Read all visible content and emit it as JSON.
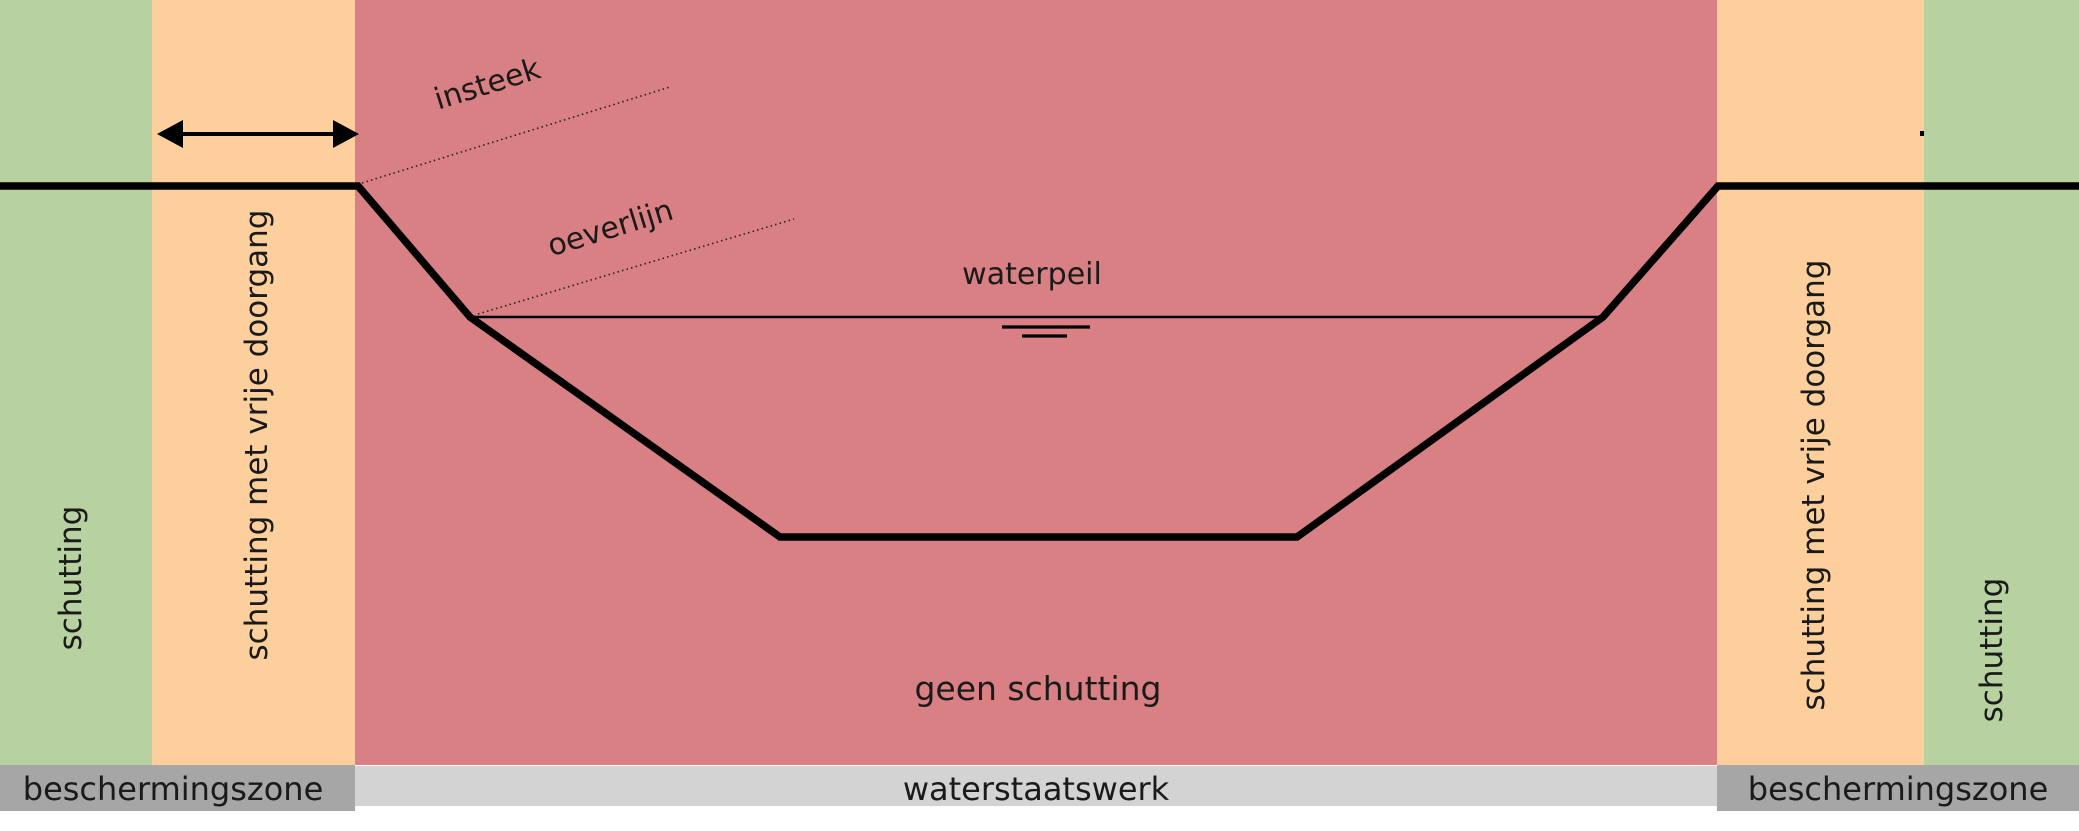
{
  "diagram": {
    "annotations": {
      "insteek": "insteek",
      "oeverlijn": "oeverlijn",
      "waterpeil": "waterpeil",
      "geen_schutting": "geen schutting"
    },
    "zone_labels": {
      "left_green": "schutting",
      "left_orange": "schutting met vrije doorgang",
      "right_orange": "schutting met vrije doorgang",
      "right_green": "schutting"
    },
    "bottom_bar": {
      "left": "beschermingszone",
      "center": "waterstaatswerk",
      "right": "beschermingszone"
    },
    "colors": {
      "zone_green": "#b7d1a0",
      "zone_orange": "#fccf9d",
      "zone_red": "#d88083",
      "bar_dark_gray": "#a6a6a6",
      "bar_light_gray": "#d3d3d3",
      "outline_black": "#000000",
      "page_white": "#ffffff"
    }
  }
}
